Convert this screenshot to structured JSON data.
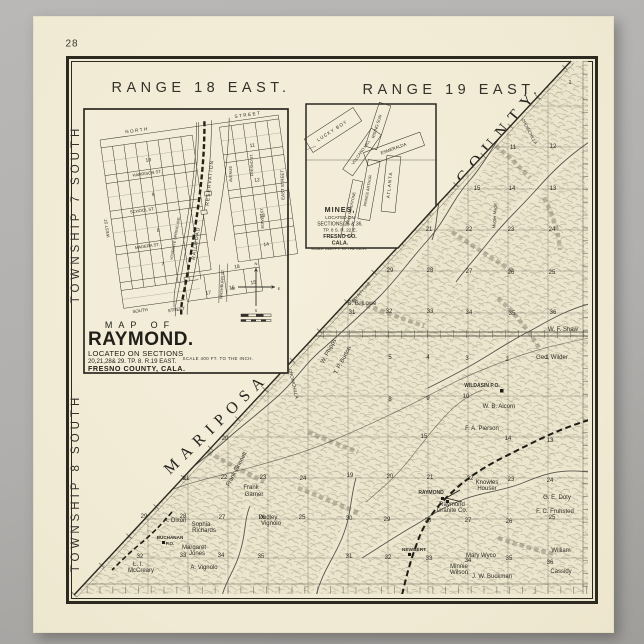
{
  "page": {
    "number": "28"
  },
  "header": {
    "range_left": "RANGE 18 EAST.",
    "range_right": "RANGE 19 EAST."
  },
  "side": {
    "township_top": "TOWNSHIP 7 SOUTH",
    "township_bottom": "TOWNSHIP 8 SOUTH"
  },
  "county_boundary": {
    "word_upper": "COUNTY",
    "word_lower": "MARIPOSA"
  },
  "colors": {
    "paper": "#f2ecd8",
    "ink": "#2b2920",
    "surround": "#b1afad"
  },
  "raymond_inset": {
    "title_lines": [
      "MAP OF",
      "RAYMOND.",
      "LOCATED ON SECTIONS",
      "20,21,28& 29. TP. 8. R.19 EAST.",
      "FRESNO  COUNTY, CALA."
    ],
    "scale_note": "SCALE 400 FT. TO THE INCH.",
    "street_labels": [
      {
        "t": "NORTH",
        "x": 38,
        "y": -3,
        "fs": 4.6,
        "ls": 1.5
      },
      {
        "t": "STREET",
        "x": 150,
        "y": -3,
        "fs": 4.6,
        "ls": 1.5
      },
      {
        "t": "HARRISON ST.",
        "x": 42,
        "y": 41,
        "fs": 4.2
      },
      {
        "t": "SCHOOL ST.",
        "x": 32,
        "y": 77,
        "fs": 4.2
      },
      {
        "t": "MADERA ST.",
        "x": 32,
        "y": 113,
        "fs": 4.2
      },
      {
        "t": "SOUTH",
        "x": 16,
        "y": 176,
        "fs": 4.4
      },
      {
        "t": "STREET",
        "x": 52,
        "y": 180,
        "fs": 4.4
      },
      {
        "t": "WEST ST.",
        "x": -4,
        "y": 88,
        "fs": 4.2,
        "r": -90
      },
      {
        "t": "RESERVATION",
        "x": 104,
        "y": 58,
        "fs": 5,
        "r": -76,
        "ls": 1
      },
      {
        "t": "RAILROAD",
        "x": 82,
        "y": 116,
        "fs": 5,
        "r": -73,
        "ls": 1
      },
      {
        "t": "YOSEMITE SPRING AVE.",
        "x": 62,
        "y": 108,
        "fs": 3.8,
        "r": -72
      },
      {
        "t": "WASHBURN ST.",
        "x": 102,
        "y": 160,
        "fs": 4,
        "r": -78
      },
      {
        "t": "EAST STREET",
        "x": 176,
        "y": 70,
        "fs": 4.4,
        "r": -84
      },
      {
        "t": "AVENUE",
        "x": 126,
        "y": 52,
        "fs": 4,
        "r": -84
      },
      {
        "t": "FRESNO ST.",
        "x": 148,
        "y": 46,
        "fs": 3.8,
        "r": -84
      },
      {
        "t": "BOWEN ST.",
        "x": 151,
        "y": 100,
        "fs": 3.8,
        "r": -84
      }
    ],
    "block_numbers": [
      {
        "t": "10",
        "x": 45,
        "y": 28,
        "fs": 5
      },
      {
        "t": "9",
        "x": 45,
        "y": 63,
        "fs": 5
      },
      {
        "t": "8",
        "x": 45,
        "y": 99,
        "fs": 5
      },
      {
        "t": "7",
        "x": 45,
        "y": 133,
        "fs": 5
      },
      {
        "t": "11",
        "x": 150,
        "y": 28,
        "fs": 5
      },
      {
        "t": "12",
        "x": 150,
        "y": 63,
        "fs": 5
      },
      {
        "t": "13",
        "x": 150,
        "y": 99,
        "fs": 5
      },
      {
        "t": "14",
        "x": 150,
        "y": 128,
        "fs": 5
      },
      {
        "t": "18",
        "x": 118,
        "y": 146,
        "fs": 5
      },
      {
        "t": "17",
        "x": 86,
        "y": 168,
        "fs": 5
      },
      {
        "t": "16",
        "x": 110,
        "y": 166,
        "fs": 5
      },
      {
        "t": "15",
        "x": 132,
        "y": 164,
        "fs": 5
      }
    ],
    "compass_letters": [
      {
        "t": "N",
        "x": 256,
        "y": 265,
        "fs": 4
      },
      {
        "t": "S",
        "x": 256,
        "y": 312,
        "fs": 4
      },
      {
        "t": "W",
        "x": 233,
        "y": 290,
        "fs": 4
      },
      {
        "t": "E",
        "x": 279,
        "y": 290,
        "fs": 4
      }
    ]
  },
  "mines_inset": {
    "label_lines": [
      "MINES,",
      "LOCATED ON",
      "SECTIONS 25 & 36.",
      "TP. 8 S. R. 22 E.",
      "FRESNO CO.",
      "CALA."
    ],
    "scale_note": "SCALE 2400 FT. TO THE INCH.",
    "claim_labels": [
      {
        "t": "LUCKY BOY",
        "x": 333,
        "y": 132,
        "fs": 4.6,
        "r": -33,
        "ls": 1
      },
      {
        "t": "RISING SUN",
        "x": 378,
        "y": 127,
        "fs": 4.2,
        "r": -72
      },
      {
        "t": "VOLCANO HILL",
        "x": 362,
        "y": 153,
        "fs": 4,
        "r": -55
      },
      {
        "t": "ESMERALDA",
        "x": 394,
        "y": 150,
        "fs": 4.4,
        "r": -20
      },
      {
        "t": "ATLANTA",
        "x": 391,
        "y": 185,
        "fs": 4.6,
        "r": -84,
        "ls": 1
      },
      {
        "t": "PRINCE ARTHUR",
        "x": 369,
        "y": 191,
        "fs": 3.9,
        "r": -80
      },
      {
        "t": "GRAY SANDSTONE",
        "x": 352,
        "y": 209,
        "fs": 3.7,
        "r": -78
      }
    ]
  },
  "terrain": {
    "sections": [
      {
        "t": "1",
        "x": 570,
        "y": 84,
        "fs": 5.5
      },
      {
        "t": "11",
        "x": 513,
        "y": 149
      },
      {
        "t": "12",
        "x": 553,
        "y": 148
      },
      {
        "t": "15",
        "x": 477,
        "y": 190
      },
      {
        "t": "14",
        "x": 512,
        "y": 190
      },
      {
        "t": "13",
        "x": 553,
        "y": 190
      },
      {
        "t": "21",
        "x": 429,
        "y": 231
      },
      {
        "t": "22",
        "x": 469,
        "y": 231
      },
      {
        "t": "23",
        "x": 511,
        "y": 231
      },
      {
        "t": "24",
        "x": 552,
        "y": 231
      },
      {
        "t": "29",
        "x": 390,
        "y": 272
      },
      {
        "t": "28",
        "x": 430,
        "y": 272
      },
      {
        "t": "27",
        "x": 469,
        "y": 273
      },
      {
        "t": "26",
        "x": 511,
        "y": 274
      },
      {
        "t": "25",
        "x": 552,
        "y": 274
      },
      {
        "t": "31",
        "x": 352,
        "y": 314
      },
      {
        "t": "32",
        "x": 389,
        "y": 313
      },
      {
        "t": "33",
        "x": 430,
        "y": 313
      },
      {
        "t": "34",
        "x": 469,
        "y": 314
      },
      {
        "t": "35",
        "x": 512,
        "y": 315
      },
      {
        "t": "36",
        "x": 553,
        "y": 314
      },
      {
        "t": "5",
        "x": 390,
        "y": 359
      },
      {
        "t": "4",
        "x": 428,
        "y": 359
      },
      {
        "t": "3",
        "x": 467,
        "y": 360
      },
      {
        "t": "2",
        "x": 507,
        "y": 361
      },
      {
        "t": "1",
        "x": 547,
        "y": 359
      },
      {
        "t": "8",
        "x": 390,
        "y": 401
      },
      {
        "t": "9",
        "x": 428,
        "y": 400
      },
      {
        "t": "10",
        "x": 466,
        "y": 398
      },
      {
        "t": "15",
        "x": 424,
        "y": 438
      },
      {
        "t": "14",
        "x": 508,
        "y": 440
      },
      {
        "t": "13",
        "x": 550,
        "y": 442
      },
      {
        "t": "20",
        "x": 225,
        "y": 440
      },
      {
        "t": "21",
        "x": 186,
        "y": 480
      },
      {
        "t": "22",
        "x": 224,
        "y": 479
      },
      {
        "t": "23",
        "x": 263,
        "y": 479
      },
      {
        "t": "24",
        "x": 303,
        "y": 480
      },
      {
        "t": "29",
        "x": 144,
        "y": 518
      },
      {
        "t": "28",
        "x": 183,
        "y": 518
      },
      {
        "t": "27",
        "x": 222,
        "y": 519
      },
      {
        "t": "26",
        "x": 262,
        "y": 519
      },
      {
        "t": "25",
        "x": 302,
        "y": 519
      },
      {
        "t": "32",
        "x": 140,
        "y": 558
      },
      {
        "t": "33",
        "x": 183,
        "y": 557
      },
      {
        "t": "34",
        "x": 221,
        "y": 557
      },
      {
        "t": "35",
        "x": 261,
        "y": 558
      },
      {
        "t": "19",
        "x": 350,
        "y": 477
      },
      {
        "t": "20",
        "x": 390,
        "y": 478
      },
      {
        "t": "21",
        "x": 430,
        "y": 479
      },
      {
        "t": "22",
        "x": 470,
        "y": 480
      },
      {
        "t": "23",
        "x": 511,
        "y": 481
      },
      {
        "t": "24",
        "x": 550,
        "y": 482
      },
      {
        "t": "30",
        "x": 349,
        "y": 520
      },
      {
        "t": "29",
        "x": 387,
        "y": 521
      },
      {
        "t": "28",
        "x": 428,
        "y": 522
      },
      {
        "t": "27",
        "x": 468,
        "y": 522
      },
      {
        "t": "26",
        "x": 509,
        "y": 523
      },
      {
        "t": "25",
        "x": 552,
        "y": 519
      },
      {
        "t": "31",
        "x": 349,
        "y": 558
      },
      {
        "t": "32",
        "x": 388,
        "y": 559
      },
      {
        "t": "33",
        "x": 429,
        "y": 560
      },
      {
        "t": "34",
        "x": 468,
        "y": 562
      },
      {
        "t": "35",
        "x": 509,
        "y": 560
      },
      {
        "t": "36",
        "x": 550,
        "y": 564
      }
    ],
    "towns": [
      {
        "t": "WILDASIN P.O.",
        "x": 482,
        "y": 387,
        "fs": 5
      },
      {
        "t": "RAYMOND",
        "x": 431,
        "y": 494,
        "fs": 5
      },
      {
        "t": "NEWBERT",
        "x": 414,
        "y": 551,
        "fs": 4.8
      },
      {
        "t": "BUCHANAN",
        "x": 170,
        "y": 539,
        "fs": 4.6
      },
      {
        "t": "P.O.",
        "x": 170,
        "y": 545,
        "fs": 4.4
      }
    ],
    "owners": [
      {
        "t": "W. F. Shaw",
        "x": 563,
        "y": 331
      },
      {
        "t": "Geo. Wilder",
        "x": 552,
        "y": 359
      },
      {
        "t": "S. B. Lowe",
        "x": 362,
        "y": 305
      },
      {
        "t": "W. B. Alcorn",
        "x": 499,
        "y": 408
      },
      {
        "t": "F. A. Pierson",
        "x": 482,
        "y": 430
      },
      {
        "t": "G. E. Doty",
        "x": 557,
        "y": 499
      },
      {
        "t": "F. C. Fruhsted",
        "x": 555,
        "y": 513
      },
      {
        "t": "Knowles",
        "x": 487,
        "y": 484
      },
      {
        "t": "Houser",
        "x": 487,
        "y": 490
      },
      {
        "t": "Raymond",
        "x": 452,
        "y": 506
      },
      {
        "t": "Granite Co.",
        "x": 452,
        "y": 512
      },
      {
        "t": "Mary Wyco",
        "x": 481,
        "y": 557
      },
      {
        "t": "Minnie",
        "x": 459,
        "y": 568
      },
      {
        "t": "Wilson",
        "x": 459,
        "y": 574
      },
      {
        "t": "J. W. Buckman",
        "x": 492,
        "y": 578
      },
      {
        "t": "William",
        "x": 561,
        "y": 552
      },
      {
        "t": "Cassidy",
        "x": 561,
        "y": 573
      },
      {
        "t": "L. I.",
        "x": 138,
        "y": 566
      },
      {
        "t": "McCreary",
        "x": 141,
        "y": 572
      },
      {
        "t": "Margaret",
        "x": 194,
        "y": 549
      },
      {
        "t": "Jones",
        "x": 197,
        "y": 555
      },
      {
        "t": "A. Vignolo",
        "x": 204,
        "y": 569
      },
      {
        "t": "Sophia",
        "x": 201,
        "y": 526
      },
      {
        "t": "Richards",
        "x": 204,
        "y": 532
      },
      {
        "t": "A. Dixon",
        "x": 175,
        "y": 522
      },
      {
        "t": "Frank",
        "x": 251,
        "y": 489
      },
      {
        "t": "Garner",
        "x": 254,
        "y": 496
      },
      {
        "t": "Dudley",
        "x": 268,
        "y": 519
      },
      {
        "t": "Vignolo",
        "x": 271,
        "y": 525
      },
      {
        "t": "Frank Grinnell",
        "x": 238,
        "y": 470,
        "r": -62
      },
      {
        "t": "W. Phipps",
        "x": 330,
        "y": 352,
        "r": -62
      },
      {
        "t": "T. P. Burton",
        "x": 344,
        "y": 361,
        "r": -62
      },
      {
        "t": "Mugler Magill",
        "x": 496,
        "y": 216,
        "r": -86,
        "fs": 4.2
      },
      {
        "t": "COUNTY LINE",
        "x": 362,
        "y": 293,
        "r": -47,
        "fs": 3.8
      }
    ],
    "waters": [
      {
        "t": "CHOWCHILLA",
        "x": 292,
        "y": 384,
        "r": 77,
        "fs": 4.6
      },
      {
        "t": "CHOWCHILLA",
        "x": 528,
        "y": 132,
        "r": 62,
        "fs": 4.3
      }
    ]
  }
}
